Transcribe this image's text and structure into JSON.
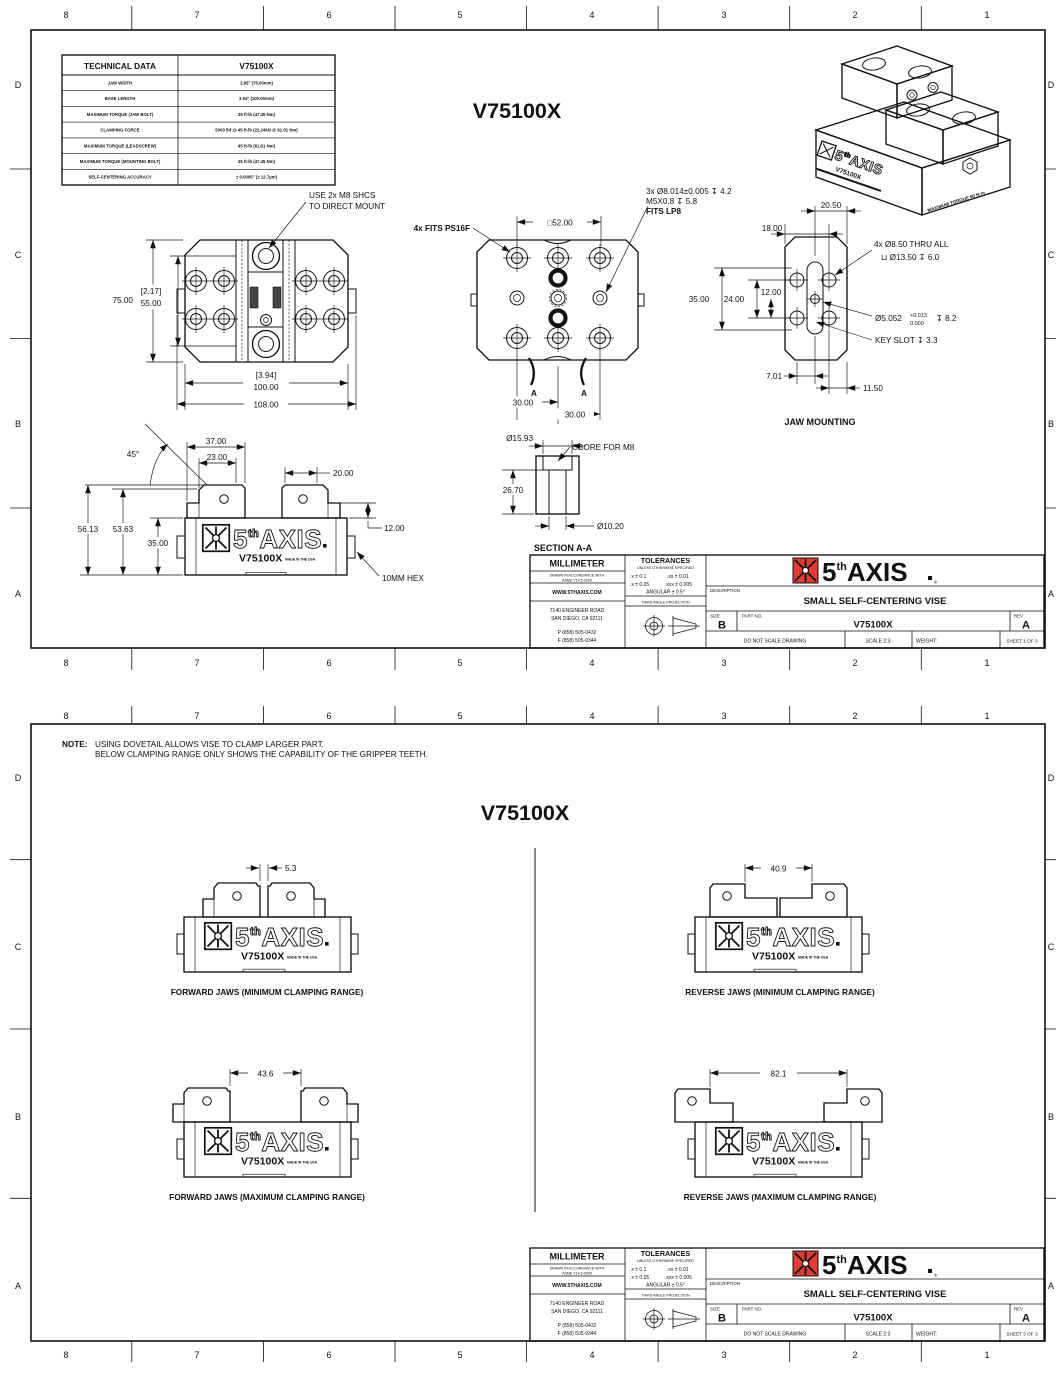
{
  "frame": {
    "columns": [
      "8",
      "7",
      "6",
      "5",
      "4",
      "3",
      "2",
      "1"
    ],
    "rows": [
      "D",
      "C",
      "B",
      "A"
    ]
  },
  "logo": {
    "five": "5",
    "sup": "th",
    "axis": "AXIS",
    "model": "V75100X",
    "made": "MADE IN THE USA",
    "reg": "®",
    "red": "#e03c31"
  },
  "tb": {
    "units": "MILLIMETER",
    "std1": "DRAWN IN ACCORDANCE WITH",
    "std2": "ASME Y14.5-2009",
    "web": "WWW.5THAXIS.COM",
    "addr1": "7140 ENGINEER ROAD",
    "addr2": "SAN DIEGO, CA 92111",
    "phone": "P (858) 505-0432",
    "fax": "F (858) 505-9344",
    "tol_title": "TOLERANCES",
    "tol_sub": "UNLESS OTHERWISE SPECIFIED",
    "t1": ".x ± 0.1",
    "t2": ".xx ± 0.01",
    "t3": ".x ± 0.05",
    "t4": ".xxx ± 0.005",
    "angular": "ANGULAR ± 0.5°",
    "proj": "THIRD ANGLE PROJECTION",
    "desc_label": "DESCRIPTION",
    "desc": "SMALL SELF-CENTERING VISE",
    "size_label": "SIZE",
    "size": "B",
    "part_label": "PART NO.",
    "part": "V75100X",
    "rev_label": "REV",
    "rev": "A",
    "noscale": "DO NOT SCALE DRAWING",
    "scale": "SCALE 2:3",
    "weight": "WEIGHT:"
  },
  "s1": {
    "sheet": "SHEET 1 OF 3",
    "title": "V75100X",
    "table": {
      "title": "TECHNICAL DATA",
      "model": "V75100X",
      "rows": [
        {
          "label": "JAW WIDTH",
          "value": "2.95\" (75.00mm)"
        },
        {
          "label": "BASE LENGTH",
          "value": "3.94\" (100.00mm)"
        },
        {
          "label": "MAXIMUM TORQUE (JAW BOLT)",
          "value": "35 ft-lb (47.45 Nm)"
        },
        {
          "label": "CLAMPING FORCE",
          "value": "5000 lbf @ 45 ft-lb (22.24kN @ 61.01 Nm)"
        },
        {
          "label": "MAXIMUM TORQUE (LEADSCREW)",
          "value": "45 ft-lb (61.01 Nm)"
        },
        {
          "label": "MAXIMUM TORQUE (MOUNTING BOLT)",
          "value": "35 ft-lb (47.45 Nm)"
        },
        {
          "label": "SELF-CENTERING ACCURACY",
          "value": "± 0.0005\" (± 12.7µm)"
        }
      ]
    },
    "top": {
      "d75": "75.00",
      "b1": "[2.17]",
      "d55": "55.00",
      "b2": "[3.94]",
      "d100": "100.00",
      "d108": "108.00",
      "cal1": "USE 2x M8 SHCS",
      "cal2": "TO DIRECT MOUNT"
    },
    "plan": {
      "fits": "4x FITS PS16F",
      "sq52": "□52.00",
      "c1": "3x Ø8.014±0.005 ↧ 4.2",
      "c2": "M5X0.8 ↧ 5.8",
      "c3": "FITS LP8",
      "d30a": "30.00",
      "d30b": "30.00",
      "a1": "A",
      "a2": "A"
    },
    "jaw": {
      "d2050": "20.50",
      "d18": "18.00",
      "d35": "35.00",
      "d24": "24.00",
      "d12": "12.00",
      "c1": "4x Ø8.50 THRU ALL",
      "c2": "⊔ Ø13.50 ↧ 6.0",
      "dia": "Ø5.052",
      "tolp": "+0.013",
      "tolm": "0.000",
      "depth": "↧ 8.2",
      "key": "KEY SLOT ↧ 3.3",
      "d701": "7.01",
      "d1150": "11.50",
      "label": "JAW MOUNTING"
    },
    "side": {
      "a45": "45°",
      "d37": "37.00",
      "d23": "23.00",
      "d20": "20.00",
      "d12": "12.00",
      "d5613": "56.13",
      "d5363": "53.63",
      "d35": "35.00",
      "hex": "10MM HEX"
    },
    "sec": {
      "d1593": "Ø15.93",
      "cbore": "CBORE FOR M8",
      "d2670": "26.70",
      "d1020": "Ø10.20",
      "label": "SECTION A-A"
    },
    "iso": {
      "torque": "MAXIMUM TORQUE 60 N·m"
    }
  },
  "s3": {
    "sheet": "SHEET 3 OF 3",
    "title": "V75100X",
    "note_label": "NOTE:",
    "note1": "USING DOVETAIL ALLOWS VISE TO CLAMP LARGER PART.",
    "note2": "BELOW CLAMPING RANGE ONLY SHOWS THE CAPABILITY OF THE GRIPPER TEETH.",
    "views": [
      {
        "dim": "5.3",
        "caption": "FORWARD JAWS (MINIMUM CLAMPING RANGE)"
      },
      {
        "dim": "40.9",
        "caption": "REVERSE JAWS (MINIMUM CLAMPING RANGE)"
      },
      {
        "dim": "43.6",
        "caption": "FORWARD JAWS (MAXIMUM CLAMPING RANGE)"
      },
      {
        "dim": "82.1",
        "caption": "REVERSE JAWS (MAXIMUM CLAMPING RANGE)"
      }
    ]
  }
}
